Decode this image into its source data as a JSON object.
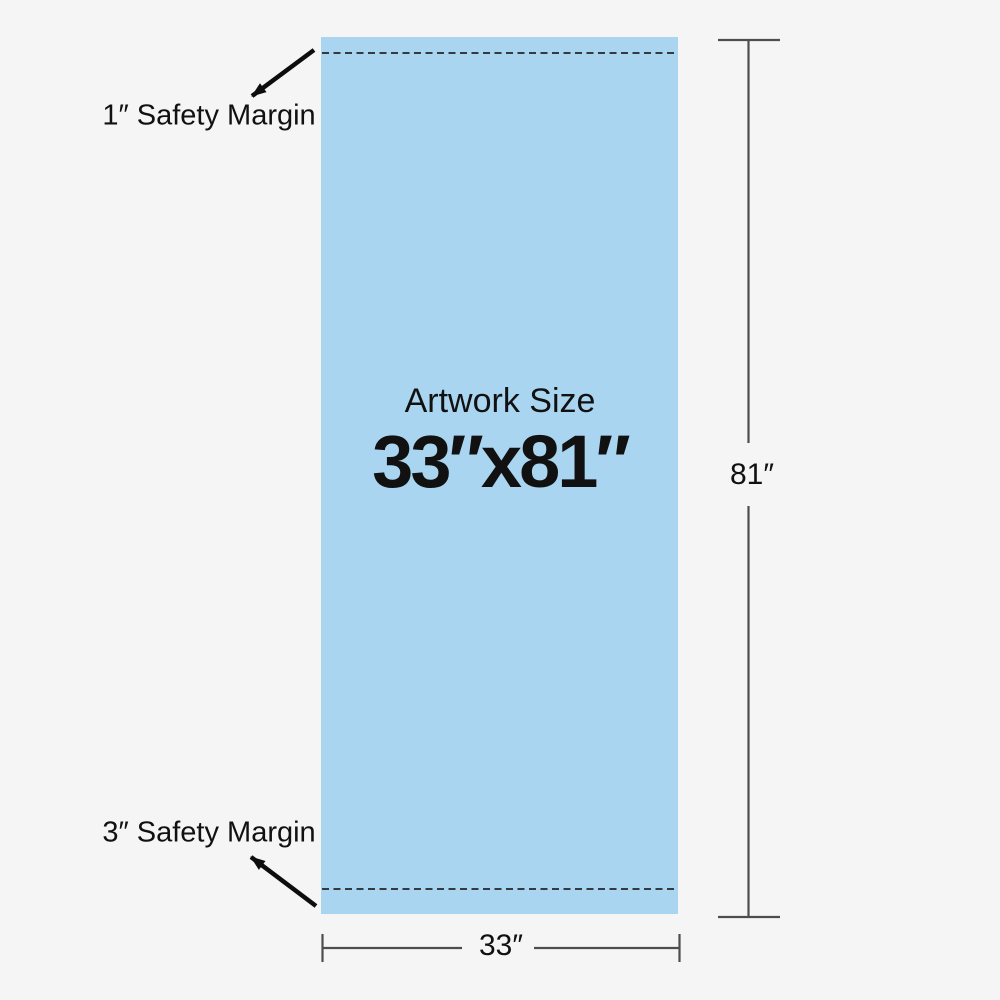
{
  "diagram": {
    "artwork": {
      "title": "Artwork Size",
      "size_label": "33″x81″"
    },
    "margins": {
      "top_label": "1″ Safety Margin",
      "bottom_label": "3″ Safety Margin"
    },
    "dimensions": {
      "height_label": "81″",
      "width_label": "33″"
    }
  },
  "colors": {
    "background": "#f5f5f5",
    "artwork_fill": "#aad5f0",
    "dashed_line": "#333a42",
    "dimension_line": "#4d4d4d",
    "arrow": "#0d0d0d",
    "text": "#111111"
  }
}
